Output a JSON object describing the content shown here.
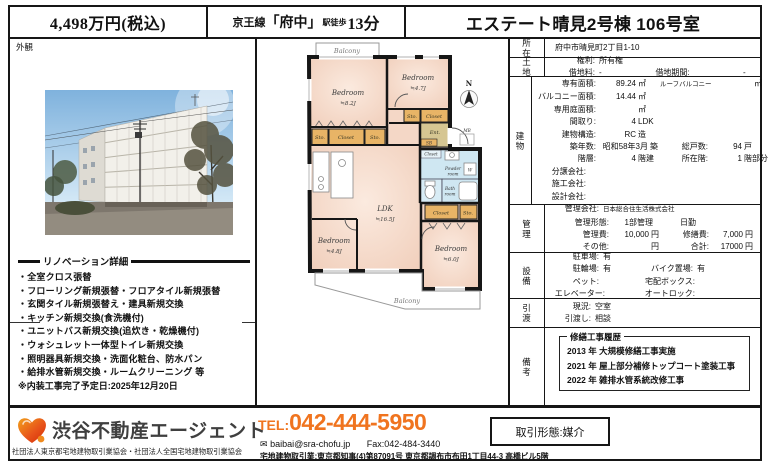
{
  "colors": {
    "accent_orange": "#f0741f",
    "room_peach": "#f4d7c6",
    "wet_blue": "#cfe7f2",
    "closet_tan": "#e8b466",
    "entrance_tan": "#d6c692",
    "border": "#161616"
  },
  "header": {
    "price": "4,498万円(税込)",
    "line": "京王線",
    "station": "「府中」",
    "walk": "駅徒歩",
    "minutes": "13分",
    "title": "エステート晴見2号棟 106号室"
  },
  "photo": {
    "label": "外観"
  },
  "fp": {
    "north": "N",
    "balcony_top": "Balcony",
    "balcony_bottom": "Balcony",
    "b1n": "Bedroom",
    "b1s": "≒8.2J",
    "b2n": "Bedroom",
    "b2s": "≒4.7J",
    "b3n": "Bedroom",
    "b3s": "≒4.8J",
    "b4n": "Bedroom",
    "b4s": "≒6.0J",
    "ldkn": "LDK",
    "ldks": "≒16.5J",
    "sto_a1": "Sto.",
    "closet_a": "Closet",
    "sto_a2": "Sto.",
    "sto_b": "Sto.",
    "closet_b": "Closet",
    "ent": "Ent.",
    "sb": "SB",
    "mb": "MB",
    "closet_w": "Closet",
    "powder1": "Powder",
    "powder2": "room",
    "w": "W",
    "bath1": "Bath",
    "bath2": "room",
    "closet_c": "Closet",
    "sto_c": "Sto."
  },
  "reno": {
    "title": "リノベーション詳細",
    "items": [
      "・全室クロス張替",
      "・フローリング新規張替・フロアタイル新規張替",
      "・玄関タイル新規張替え・建具新規交換",
      "・キッチン新規交換(食洗機付)",
      "・ユニットバス新規交換(追炊き・乾燥機付)",
      "・ウォシュレット一体型トイレ新規交換",
      "・照明器具新規交換・洗面化粧台、防水パン",
      "・給排水管新規交換・ルームクリーニング 等"
    ],
    "note": "※内装工事完了予定日:2025年12月20日"
  },
  "table": {
    "loc_label": "所在",
    "loc_value": "府中市晴見町2丁目1-10",
    "land_label": "土地",
    "right_label": "権利:",
    "right_value": "所有権",
    "fee_label": "借地料:",
    "fee_value": "-",
    "term_label": "借地期間:",
    "term_value": "-",
    "bldg_label": "建物",
    "area_label": "専有面積:",
    "area_value": "89.24",
    "area_unit": "㎡",
    "roof_label": "ルーフバルコニー",
    "roof_unit": "㎡",
    "balc_label": "バルコニー面積:",
    "balc_value": "14.44",
    "balc_unit": "㎡",
    "garden_label": "専用庭面積:",
    "garden_unit": "㎡",
    "madori_label": "間取り:",
    "madori_value": "4",
    "madori_unit": "LDK",
    "struct_label": "建物構造:",
    "struct_value": "RC",
    "struct_unit": "造",
    "age_label": "築年数:",
    "age_value": "昭和58年3月",
    "age_unit": "築",
    "units_label": "総戸数:",
    "units_value": "94",
    "units_unit": "戸",
    "floors_label": "階層:",
    "floors_value": "4",
    "floors_unit": "階建",
    "floor_label": "所在階:",
    "floor_value": "1",
    "floor_unit": "階部分",
    "seller_label": "分譲会社:",
    "builder_label": "施工会社:",
    "designer_label": "設計会社:",
    "mgmt_label": "管理",
    "mco_label": "管理会社:",
    "mco_value": "日本総合住生活株式会社",
    "mform_label": "管理形態:",
    "mform_value": "1部管理",
    "mduty": "日勤",
    "mfee_label": "管理費:",
    "mfee_value": "10,000",
    "mfee_unit": "円",
    "mrep_label": "修繕費:",
    "mrep_value": "7,000",
    "mrep_unit": "円",
    "other_label": "その他:",
    "other_unit": "円",
    "total_label": "合計:",
    "total_value": "17000",
    "total_unit": "円",
    "equip_label": "設備",
    "park_label": "駐車場:",
    "park_value": "有",
    "bicycle_label": "駐輪場:",
    "bicycle_value": "有",
    "bike_label": "バイク置場:",
    "bike_value": "有",
    "pet_label": "ペット:",
    "delivery_label": "宅配ボックス:",
    "elev_label": "エレベーター:",
    "lock_label": "オートロック:",
    "hand_label": "引渡",
    "status_label": "現況:",
    "status_value": "空室",
    "handover_label": "引渡し:",
    "handover_value": "相談",
    "notes_label": "備考",
    "hist_title": "修繕工事履歴",
    "hist": [
      "2013 年 大規模修繕工事実施",
      "2021 年 屋上部分補修トップコート塗装工事",
      "2022 年 雑排水管系統改修工事"
    ]
  },
  "footer": {
    "brand": "渋谷不動産エージェント",
    "associations": "社団法人東京都宅地建物取引業協会・社団法人全国宅地建物取引業協会",
    "tel_label": "TEL:",
    "tel": "042-444-5950",
    "email_icon": "✉",
    "email": "baibai@sra-chofu.jp",
    "fax": "Fax:042-484-3440",
    "license": "宅地建物取引業:東京都知事(4)第87091号  東京都調布市布田1丁目44-3 高橋ビル5階",
    "deal_type": "取引形態:媒介"
  }
}
